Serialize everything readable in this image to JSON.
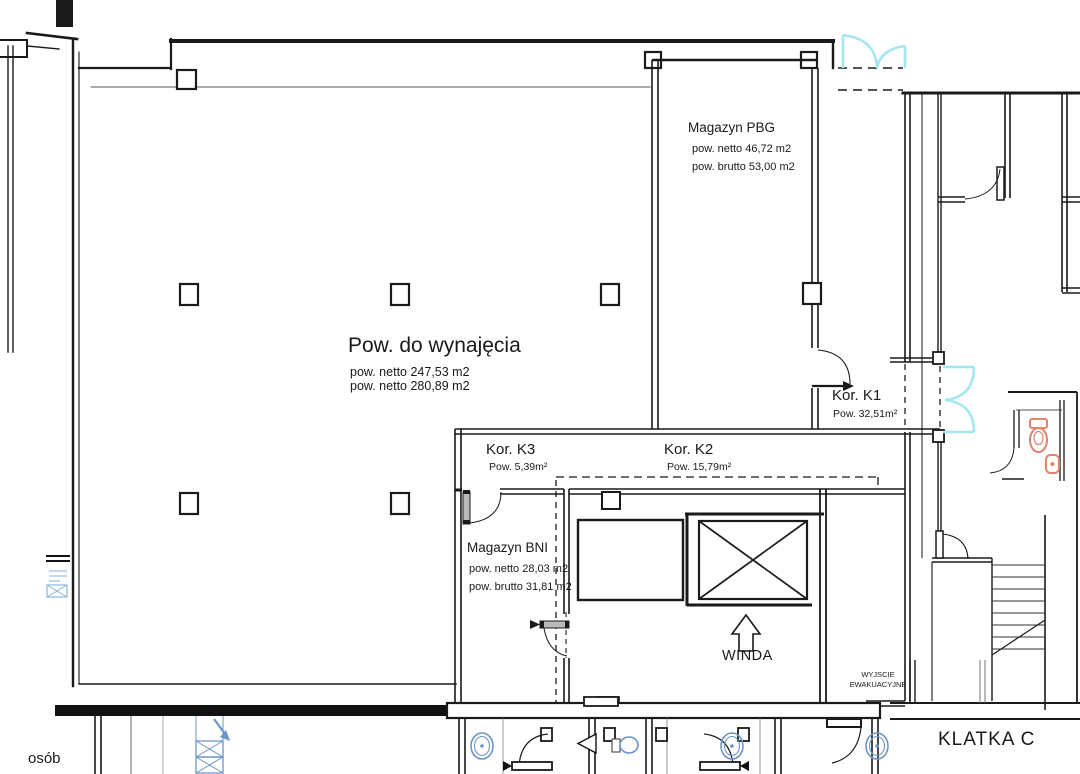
{
  "rooms": {
    "rentable": {
      "name": "Pow. do wynajęcia",
      "line1": "pow. netto 247,53 m2",
      "line2": "pow. netto 280,89 m2"
    },
    "pbg": {
      "name": "Magazyn PBG",
      "line1": "pow. netto 46,72 m2",
      "line2": "pow. brutto 53,00 m2"
    },
    "k1": {
      "name": "Kor. K1",
      "area": "Pow. 32,51m²"
    },
    "k2": {
      "name": "Kor. K2",
      "area": "Pow. 15,79m²"
    },
    "k3": {
      "name": "Kor. K3",
      "area": "Pow. 5,39m²"
    },
    "bni": {
      "name": "Magazyn BNI",
      "line1": "pow. netto 28,03 m2",
      "line2": "pow. brutto 31,81 m2"
    }
  },
  "labels": {
    "elevator": "WINDA",
    "exit_line1": "WYJSCIE",
    "exit_line2": "EWAKUACYJNE",
    "staircase": "KLATKA C",
    "edge_text": "osób"
  },
  "colors": {
    "line": "#1a1a1a",
    "door_cyan": "#a5e7f0",
    "fixture_orange": "#e2836c",
    "fixture_blue": "#6d94c9"
  },
  "symbols": {
    "elevator-cross-icon": "crossed-box elevator shaft",
    "up-arrow-icon": "outline arrow pointing up to elevator",
    "door-arc-icon": "quarter-circle door swing",
    "double-swing-door-icon": "cyan double swing door",
    "stairs-icon": "stair treads with cut line",
    "toilet-icon": "orange WC bowl",
    "urinal-icon": "orange wall fixture",
    "column-icon": "square structural column",
    "shaft-hatch-icon": "blue crossed duct shaft",
    "lamp-icon": "blue oval ceiling fixture"
  }
}
